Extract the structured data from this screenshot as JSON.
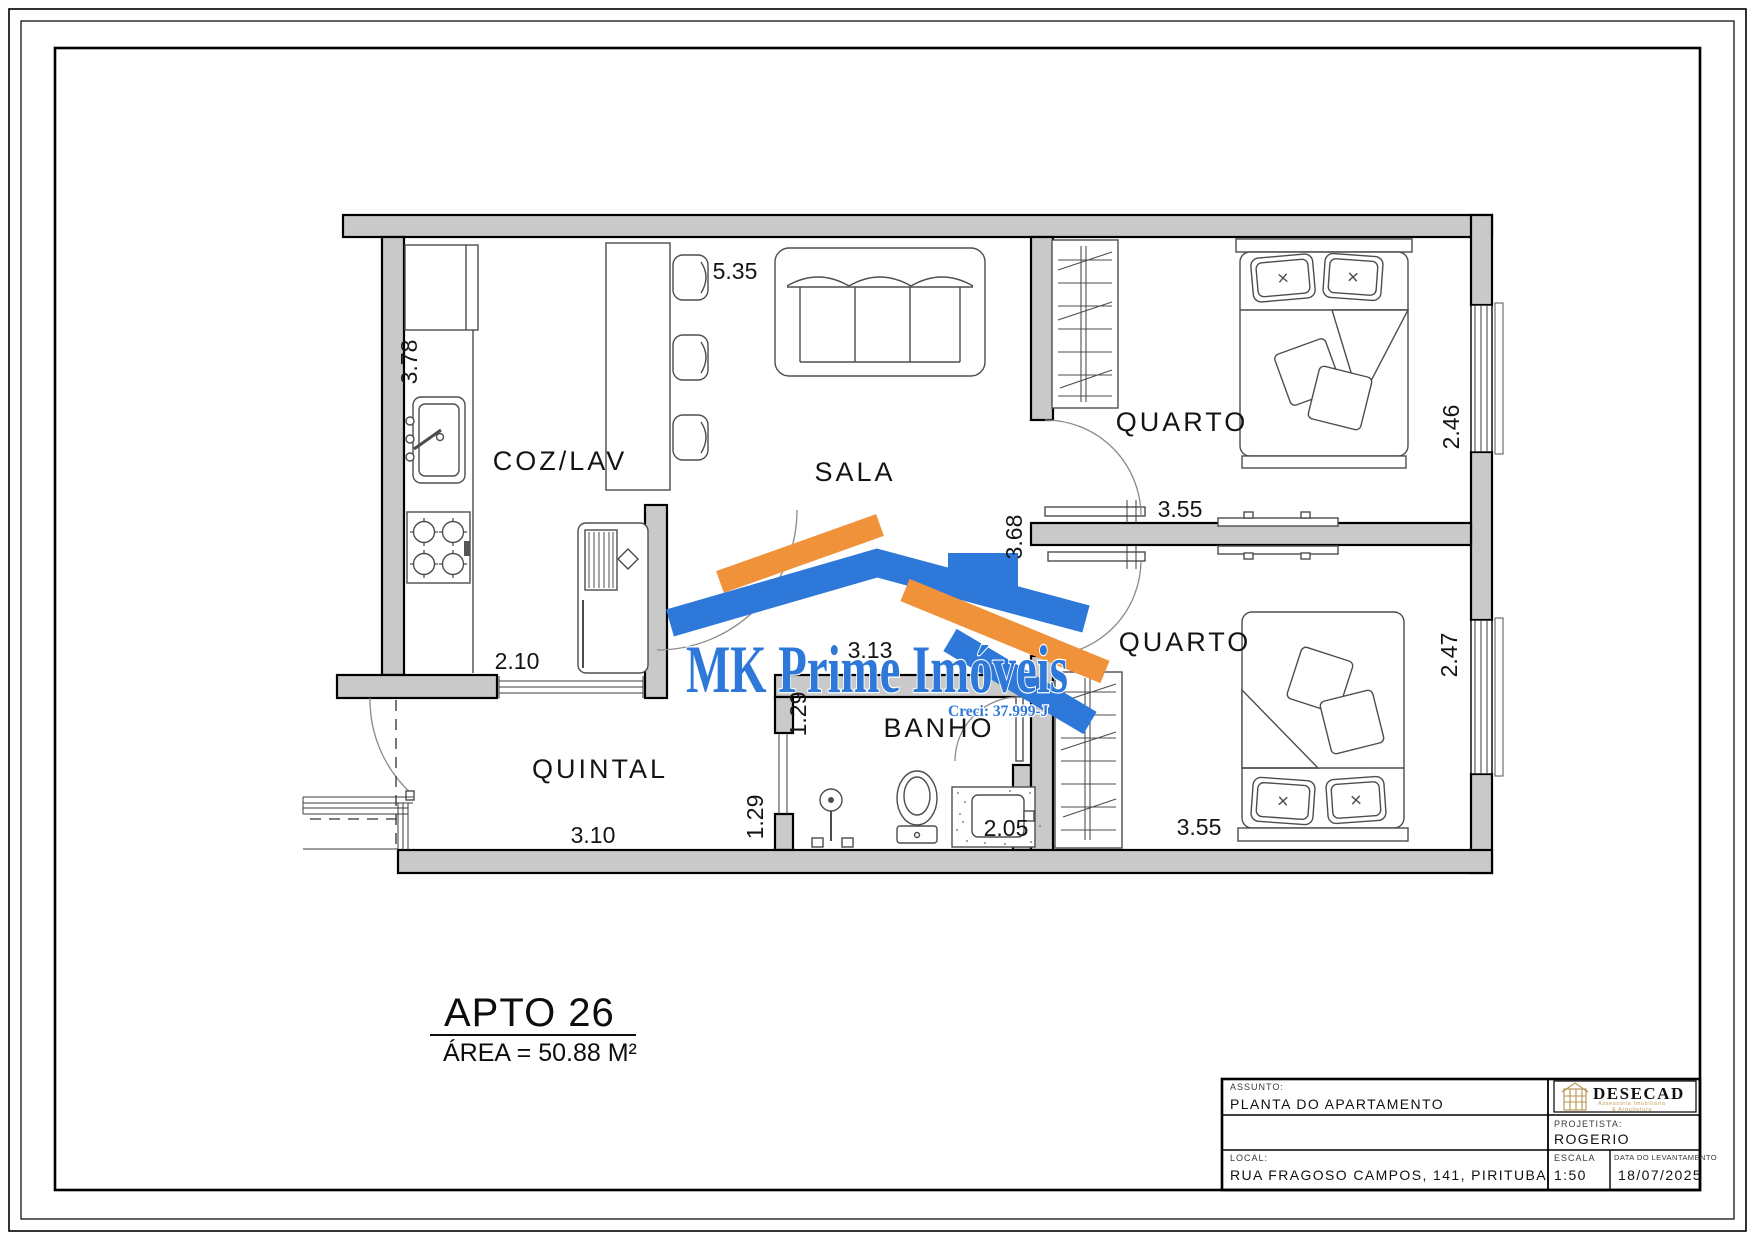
{
  "document": {
    "type": "apartment-floor-plan"
  },
  "apartment": {
    "title": "APTO 26",
    "area_label": "ÁREA = 50.88 M²"
  },
  "rooms": {
    "coz_lav": "COZ/LAV",
    "sala": "SALA",
    "quarto_top": "QUARTO",
    "quarto_bottom": "QUARTO",
    "banho": "BANHO",
    "quintal": "QUINTAL"
  },
  "dimensions": {
    "sala_top": "5.35",
    "cozinha_left": "3.78",
    "cozinha_door": "2.10",
    "quintal_bottom": "3.10",
    "corredor_upper": "1.29",
    "corredor_lower": "1.29",
    "sala_bottom": "3.13",
    "banho_bottom": "2.05",
    "sala_right": "3.68",
    "quarto_top_width": "3.55",
    "quarto_bottom_width": "3.55",
    "quarto_top_depth": "2.46",
    "quarto_bottom_depth": "2.47"
  },
  "watermark": {
    "brand": "MK Prime Imóveis",
    "creci": "Creci: 37.999-J"
  },
  "title_block": {
    "assunto_label": "ASSUNTO:",
    "assunto_value": "PLANTA DO APARTAMENTO",
    "projetista_label": "PROJETISTA:",
    "projetista_value": "ROGERIO",
    "local_label": "LOCAL:",
    "local_value": "RUA FRAGOSO CAMPOS, 141, PIRITUBA",
    "escala_label": "ESCALA",
    "escala_value": "1:50",
    "data_label": "DATA DO LEVANTAMENTO",
    "data_value": "18/07/2025",
    "logo_name": "DESECAD",
    "logo_subtitle_1": "Assessoria Imobiliária",
    "logo_subtitle_2": "& Arquitetura"
  },
  "colors": {
    "wall_fill": "#c9c9c9",
    "line": "#000000",
    "watermark_blue": "#2d78d8",
    "watermark_orange": "#f0923a",
    "logo_gold": "#b5924f"
  }
}
